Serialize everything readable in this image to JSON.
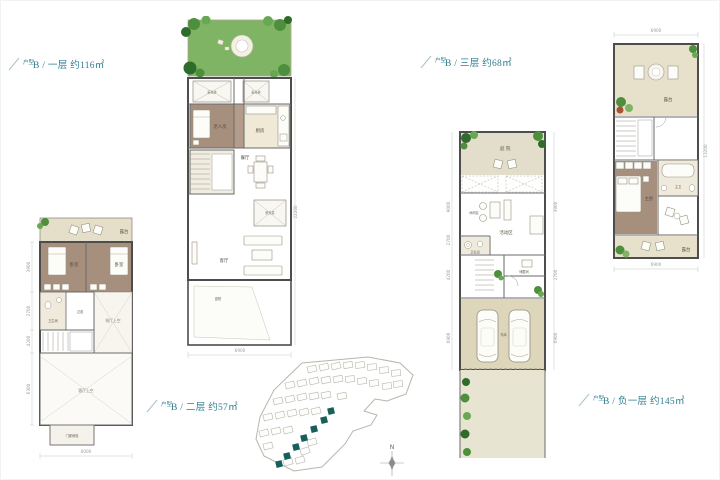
{
  "colors": {
    "accent": "#2e7d8e",
    "garden_green": "#7fb465",
    "floor_beige": "#e9e3cd",
    "wood_brown": "#a78f7d",
    "site_highlight": "#17605a"
  },
  "units": {
    "floor1": {
      "prefix": "户型",
      "title": "B / 一层 约116㎡"
    },
    "floor2": {
      "prefix": "户型",
      "title": "B / 二层 约57㎡"
    },
    "floor3": {
      "prefix": "户型",
      "title": "B / 三层 约68㎡"
    },
    "basement": {
      "prefix": "户型",
      "title": "B / 负一层 约145㎡"
    }
  },
  "plan1": {
    "rooms": {
      "lightwell_a": "采光井",
      "lightwell_b": "采光井",
      "elder_room": "老人房",
      "kitchen": "厨房",
      "dining": "餐厅",
      "lightwell_c": "采光井",
      "living": "客厅",
      "yard": "庭院"
    },
    "dims": {
      "bottom": "6900",
      "right": "22200"
    }
  },
  "plan2": {
    "rooms": {
      "terrace": "露台",
      "bedroom_a": "卧室",
      "bedroom_b": "卧室",
      "bath": "卫生间",
      "corridor": "过道",
      "dining_void": "餐厅上空",
      "living_void": "客厅上空",
      "canopy": "门廊雨篷"
    },
    "dims": {
      "left_a": "3900",
      "left_b": "2700",
      "left_c": "4200",
      "left_d": "6300",
      "bottom": "6000"
    }
  },
  "plan3": {
    "rooms": {
      "terrace_top": "露台",
      "master_bath": "主卫",
      "master_bedroom": "主卧",
      "terrace_bottom": "露台"
    },
    "dims": {
      "top": "6900",
      "bottom": "6900",
      "right": "13200"
    }
  },
  "plan4": {
    "rooms": {
      "courtyard": "庭院",
      "leisure": "休闲区",
      "activity": "活动区",
      "bath": "卫生间",
      "storage": "储藏间",
      "garage": "车库"
    },
    "dims": {
      "left_a": "9000",
      "left_b": "2700",
      "left_c": "4200",
      "left_d": "6900",
      "right_a": "3900",
      "right_b": "2700",
      "right_c": "6900"
    }
  },
  "siteplan": {
    "north": "N"
  }
}
